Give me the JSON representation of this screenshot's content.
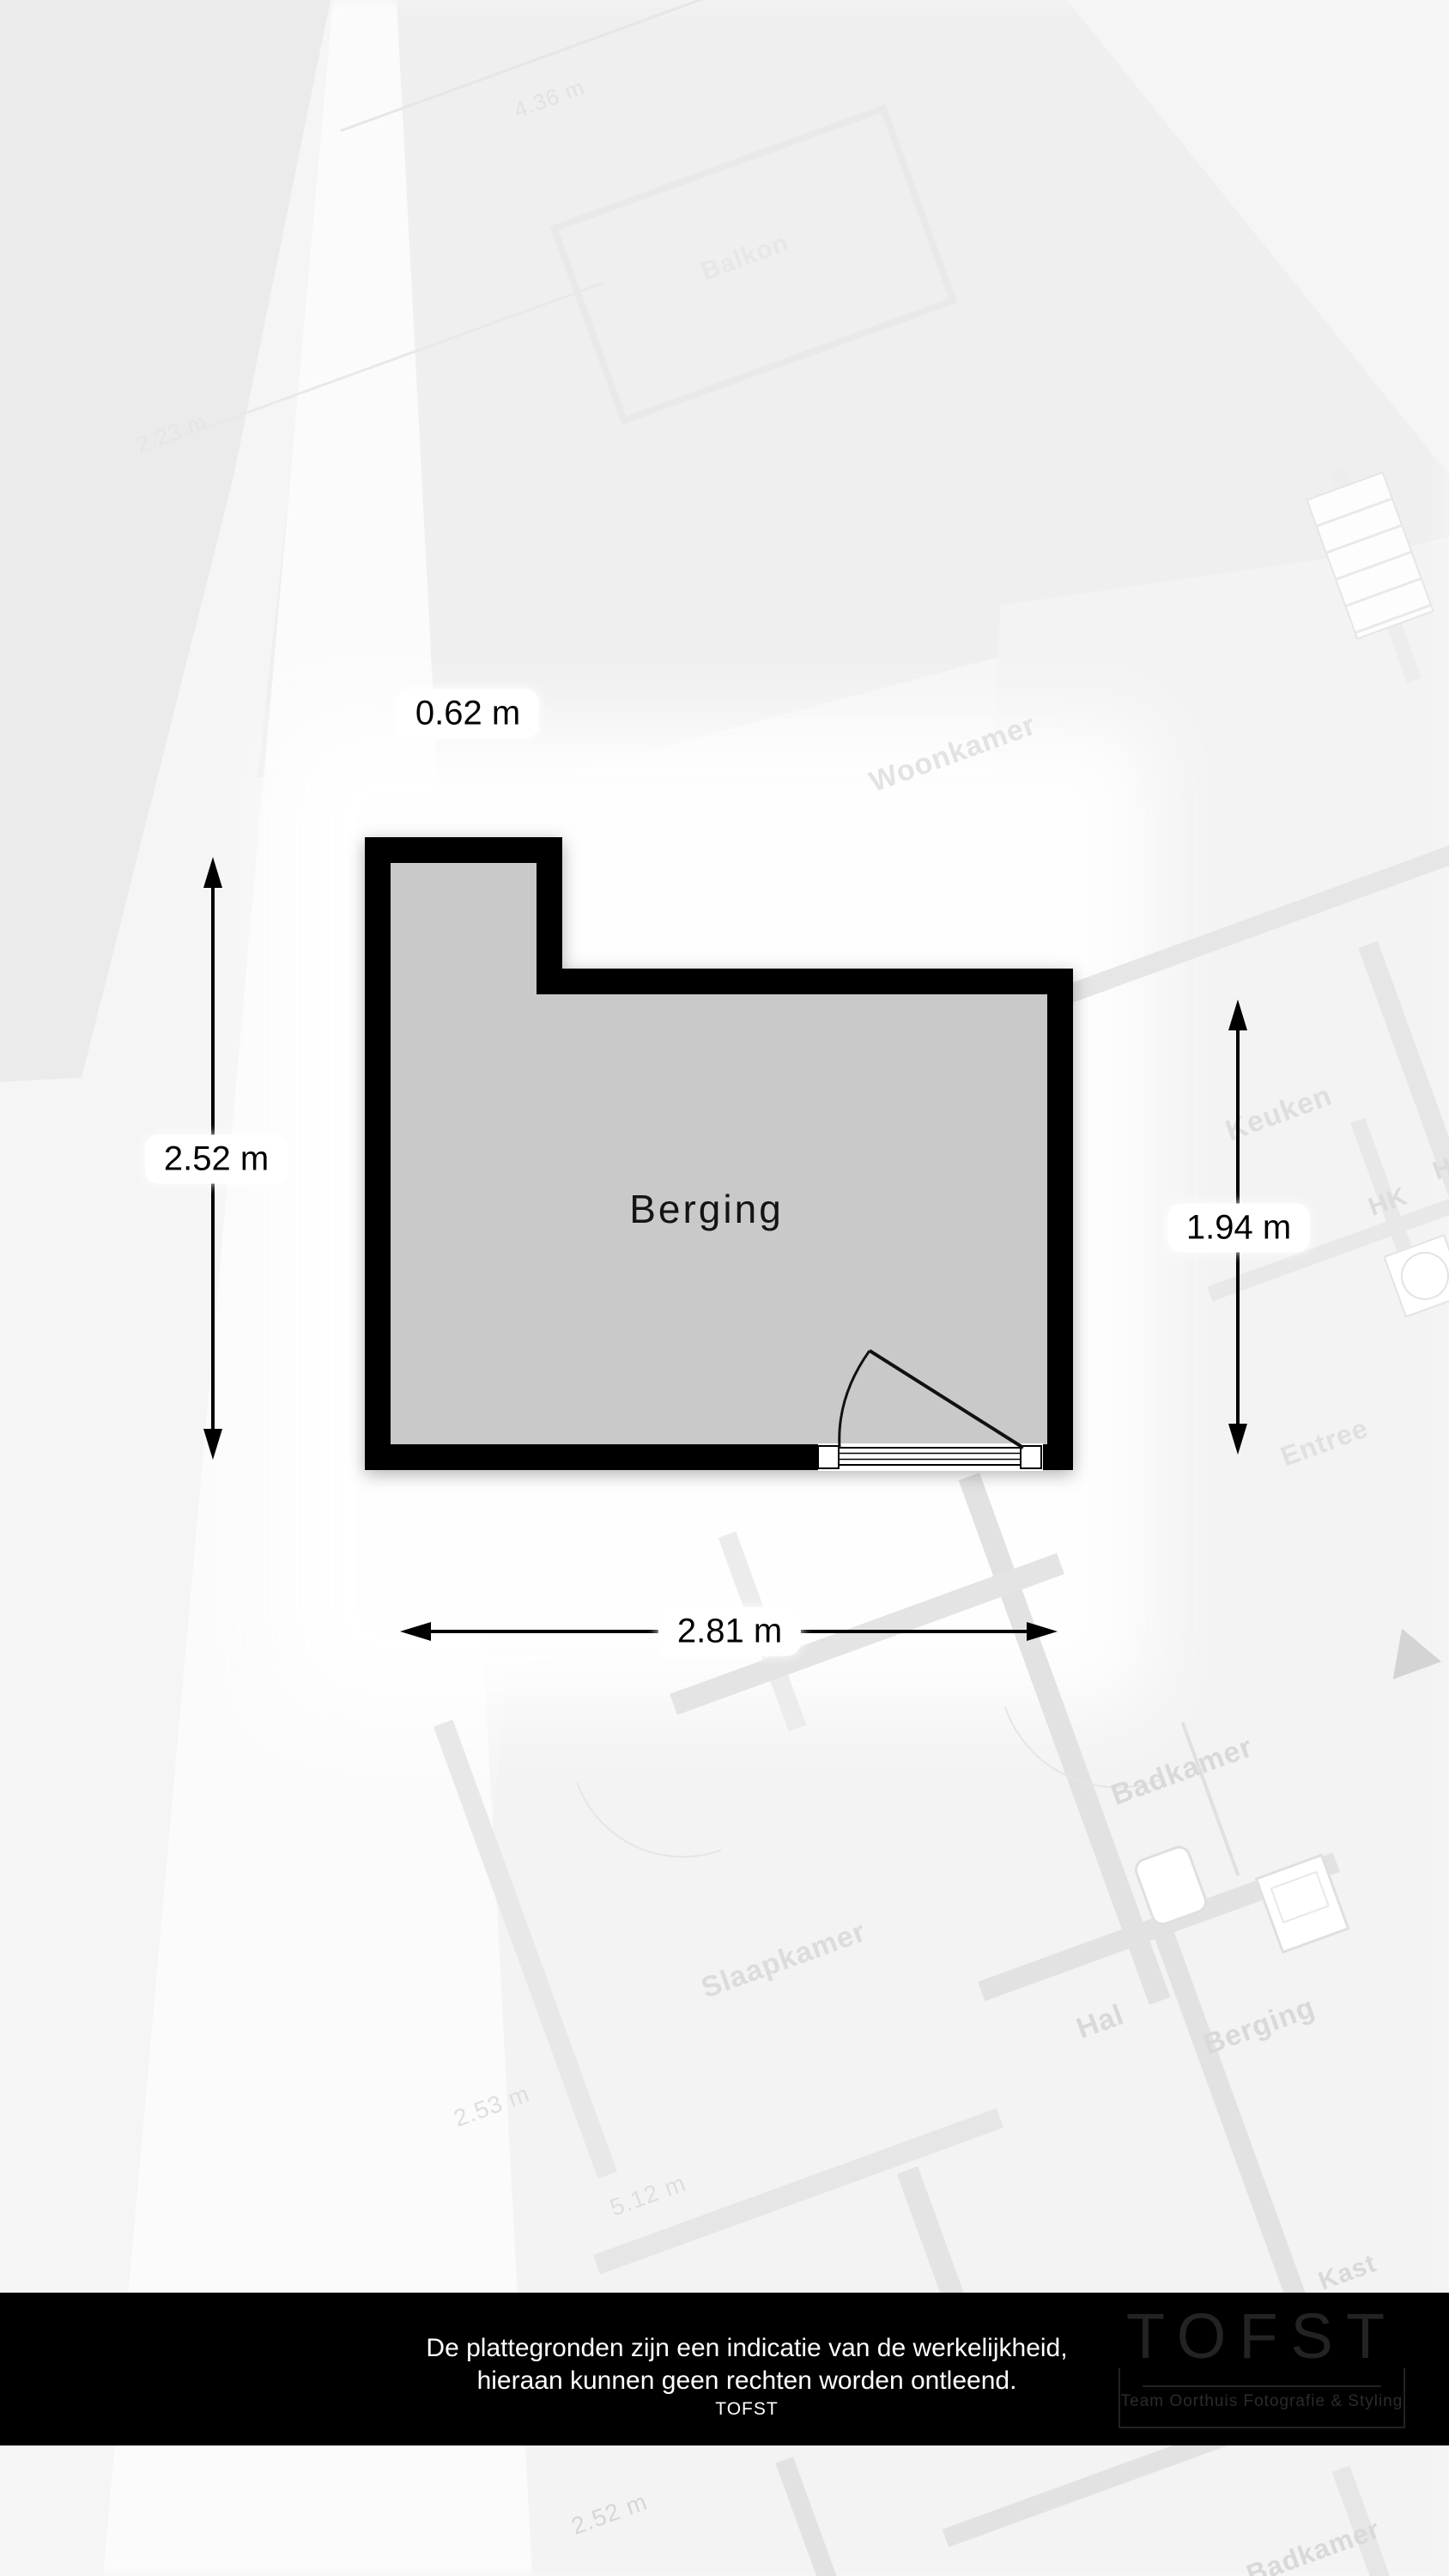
{
  "room": {
    "label": "Berging",
    "dim_top": "0.62 m",
    "dim_left": "2.52 m",
    "dim_right": "1.94 m",
    "dim_bottom": "2.81 m"
  },
  "background": {
    "labels": [
      {
        "text": "Woonkamer"
      },
      {
        "text": "Balkon"
      },
      {
        "text": "Keuken"
      },
      {
        "text": "HK"
      },
      {
        "text": "HK"
      },
      {
        "text": "Entree"
      },
      {
        "text": "Badkamer"
      },
      {
        "text": "Hal"
      },
      {
        "text": "Berging"
      },
      {
        "text": "Slaapkamer"
      },
      {
        "text": "Kast"
      },
      {
        "text": "Badkamer"
      },
      {
        "text": "4.36 m"
      },
      {
        "text": "2.23 m"
      },
      {
        "text": "2.53 m"
      },
      {
        "text": "5.12 m"
      },
      {
        "text": "2.52 m"
      }
    ]
  },
  "footer": {
    "line1": "De plattegronden zijn een indicatie van de werkelijkheid,",
    "line2": "hieraan kunnen geen rechten worden ontleend.",
    "line3": "TOFST",
    "logo_title": "TOFST",
    "logo_subtitle": "Team Oorthuis Fotografie & Styling"
  },
  "colors": {
    "wall": "#000000",
    "room_fill": "#c9c9c9",
    "footer_bar": "#000000",
    "footer_text": "#ffffff",
    "dim_text": "#000000"
  }
}
